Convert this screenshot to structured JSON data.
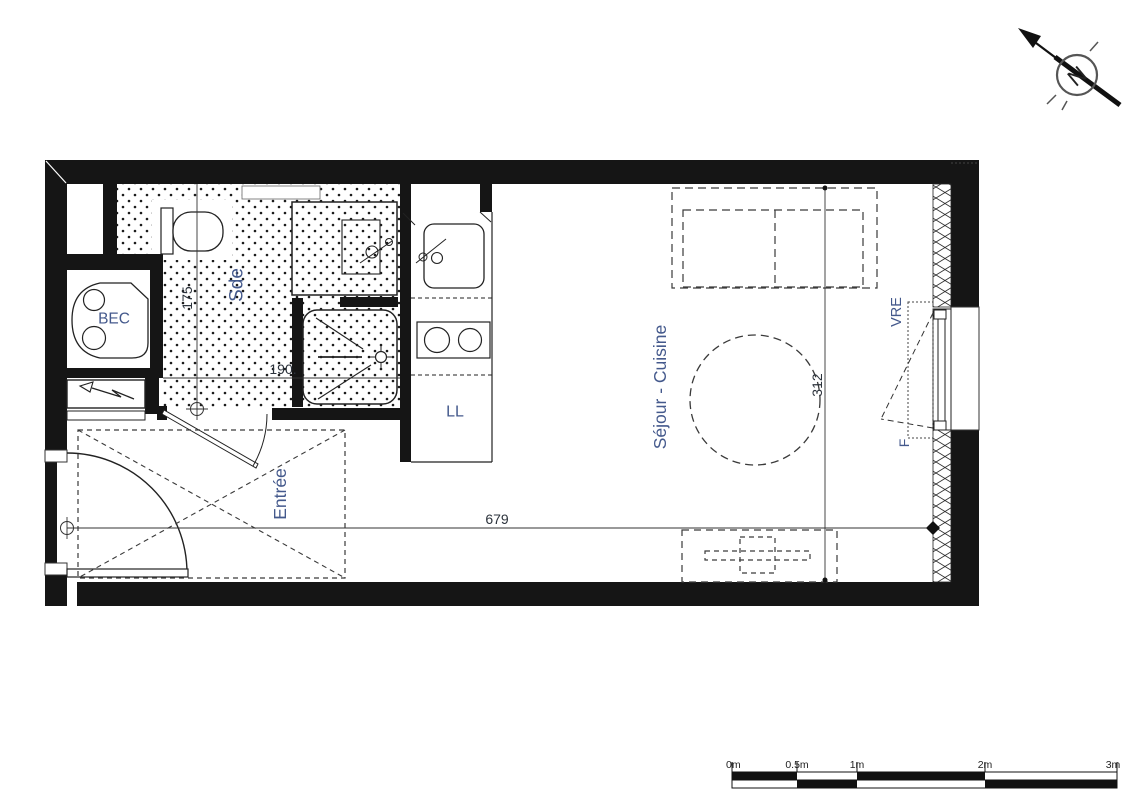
{
  "plan": {
    "rooms": {
      "bathroom_label": "Sde",
      "bec_label": "BEC",
      "laundry_label": "LL",
      "living_kitchen_label": "Séjour - Cuisine",
      "entry_label": "Entrée",
      "shutter_label": "VRE",
      "window_label": "F"
    },
    "dimensions": {
      "bathroom_width": "175",
      "bathroom_depth": "190.",
      "living_depth": "312",
      "living_width": "679"
    },
    "compass": {
      "north_letter": "N"
    },
    "scale_bar": {
      "labels": [
        "0m",
        "0.5m",
        "1m",
        "2m",
        "3m"
      ]
    },
    "colors": {
      "ink": "#1a1a1a",
      "room_label": "#44598c",
      "dim_text": "#2c333c"
    }
  }
}
